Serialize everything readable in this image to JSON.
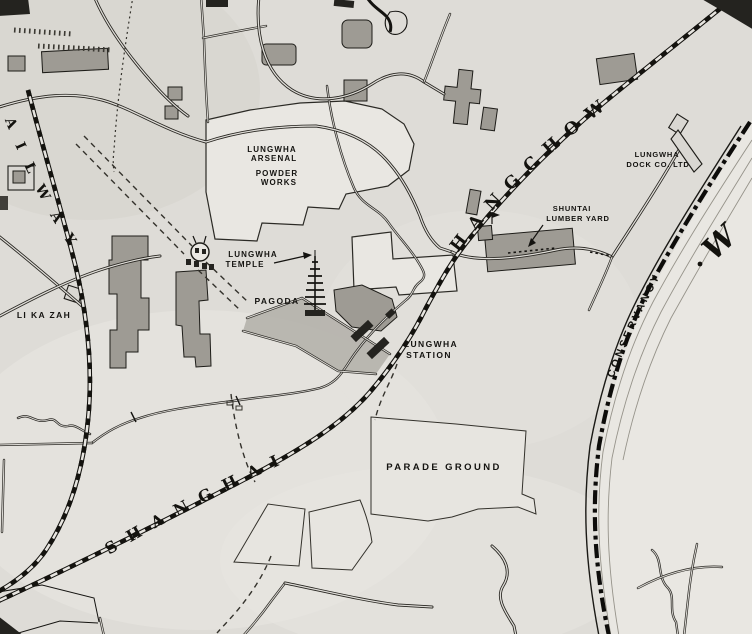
{
  "palette": {
    "paper": "#dedcd7",
    "ink": "#14130f",
    "building_shade": "#9e9b94",
    "compound_light": "#e9e7e2"
  },
  "labels": {
    "arsenal": {
      "line1": "LUNGWHA",
      "line2": "ARSENAL"
    },
    "powder_works": {
      "line1": "POWDER",
      "line2": "WORKS"
    },
    "temple": {
      "line1": "LUNGWHA",
      "line2": "TEMPLE"
    },
    "pagoda": {
      "text": "PAGODA"
    },
    "station": {
      "line1": "LUNGWHA",
      "line2": "STATION"
    },
    "parade_ground": {
      "text": "PARADE GROUND"
    },
    "lumber_yard": {
      "line1": "SHUNTAI",
      "line2": "LUMBER YARD"
    },
    "dock": {
      "line1": "LUNGWHA",
      "line2": "DOCK CO. LTD"
    },
    "li_ka_zah": {
      "text": "LI KA ZAH"
    },
    "railway_lower": {
      "text": "SHANGHAI"
    },
    "railway_upper": {
      "text": "HANGCHOW"
    },
    "railway_left_partial": {
      "text": "AILWAY"
    },
    "conservancy": {
      "text": "CONSERVANCY"
    },
    "river_partial": {
      "text": "W"
    }
  }
}
